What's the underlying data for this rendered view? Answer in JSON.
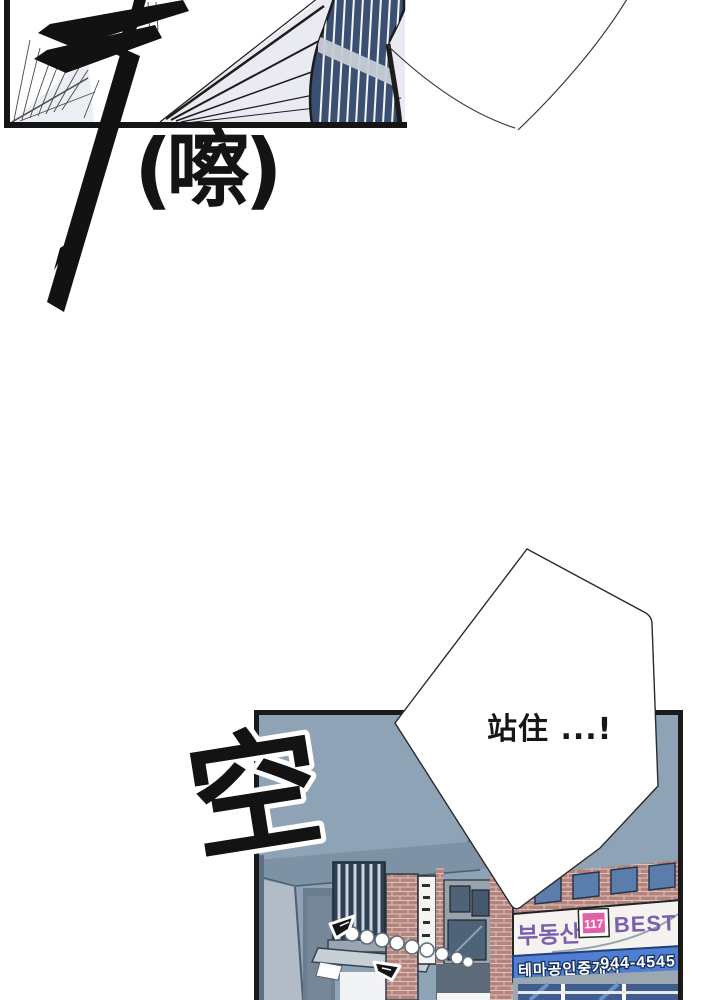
{
  "page": {
    "bg": "#ffffff"
  },
  "top_panel": {
    "caption": "(嚓)"
  },
  "bottom_panel": {
    "sfx": "空",
    "speech_bubble_text": "站住 ...!",
    "signs": {
      "realty": "부동산",
      "badge": "117",
      "best": "BEST",
      "agency": "테마공인중개사",
      "phone": "944-4545"
    },
    "colors": {
      "panel_bg": "#8fa3b6",
      "eave_shadow": "#7e92a5",
      "brick": "#b5837b",
      "sign_blue": "#4f7ed2",
      "badge_pink": "#e160a8",
      "sign_purple": "#7a5fae",
      "window_glass": "#4e6378",
      "storefront_glass": "#3f5e8e"
    }
  }
}
